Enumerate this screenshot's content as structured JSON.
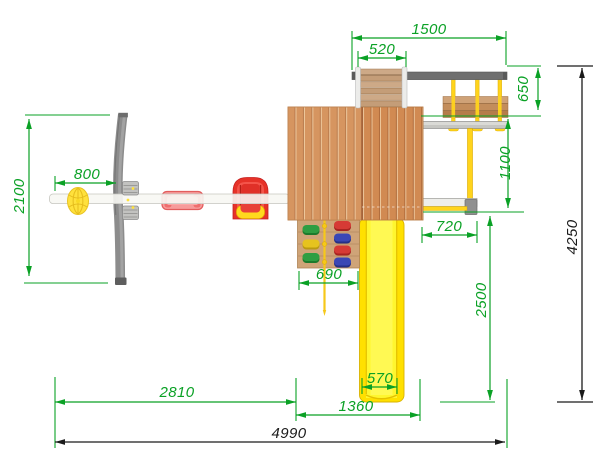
{
  "drawing": {
    "type": "playground-top-view-technical-drawing",
    "unit": "mm",
    "dims": {
      "d1500": "1500",
      "d520": "520",
      "d650": "650",
      "d1100": "1100",
      "d720": "720",
      "d690": "690",
      "d570": "570",
      "d1360": "1360",
      "d2810": "2810",
      "d800": "800",
      "d2100": "2100",
      "d2500": "2500",
      "d4990": "4990",
      "d4250": "4250"
    },
    "colors": {
      "dimension_green": "#0aa125",
      "dimension_black": "#1b1b1b",
      "roof_wood": "#d18a52",
      "panel_wood": "#cfa478",
      "slide_yellow": "#ffe000",
      "rope_yellow": "#ffd41c",
      "frame_gray": "#8c8c8c",
      "seat_red": "#e63228",
      "trapeze_pink": "#f79b9b",
      "ball_yellow": "#ffe13c",
      "beam_white": "#f7f7f3"
    }
  }
}
